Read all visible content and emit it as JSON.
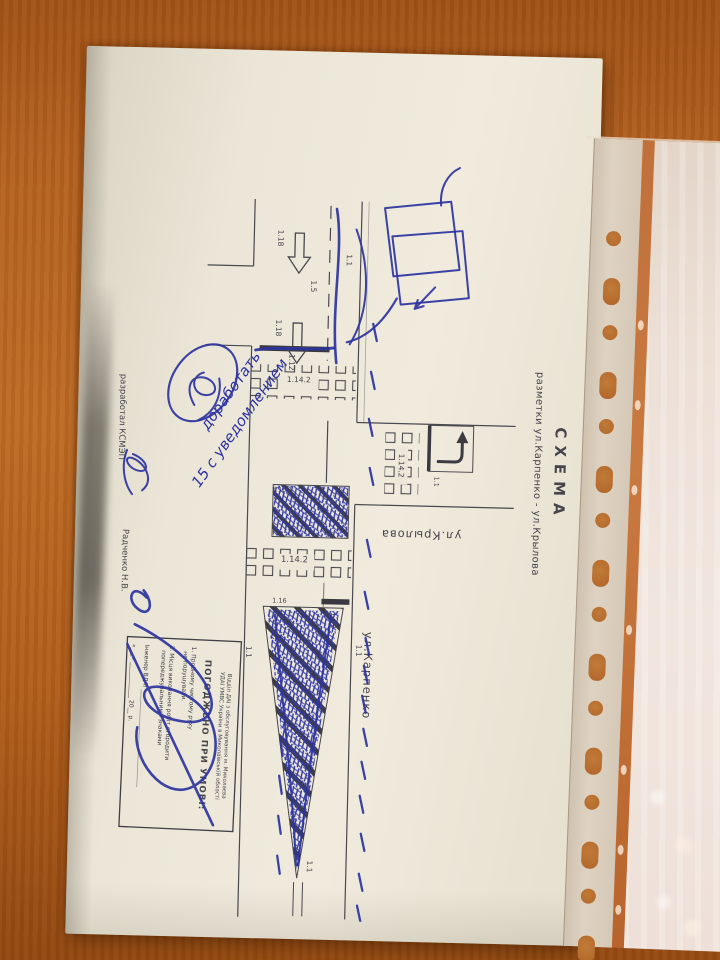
{
  "document": {
    "title": "СХЕМА",
    "subtitle": "разметки  ул.Карпенко - ул.Крылова",
    "street_main": "ул.Карпенко",
    "street_cross": "ул.Крылова",
    "developer_label": "разработал КСМЭП",
    "developer_name": "Радченко Н.В.",
    "markings": {
      "solid_line": "1.1",
      "lane_line": "1.5",
      "stop_line": "1.12",
      "crosswalk": "1.14.2",
      "island_small": "1.16.1",
      "island_wedge": "1.16",
      "lane_arrow": "1.18"
    },
    "stamp": {
      "org_line1": "Відділ ДАІ з обслуговування м. Миколаєва",
      "org_line2": "УДАІ УМВС України в Миколаївській області",
      "approved": "ПОГОДЖЕНО ПРИ УМОВІ:",
      "item1a": "1. Пробному чистому руху",
      "item1b": "не порушувати.",
      "item2a": "2. Місця виконання робіт огородити",
      "item2b": "попереджувальними знаками",
      "signer": "Інженер ВДАІ",
      "date_line": "«___» ____________ 20__ р."
    },
    "handwriting": {
      "note1": "доработать",
      "note2": "15 с уведомлением"
    }
  },
  "colors": {
    "table": "#b26020",
    "paper": "#ece7d8",
    "print_ink": "#46454c",
    "pen_ink": "#2c33a0"
  }
}
